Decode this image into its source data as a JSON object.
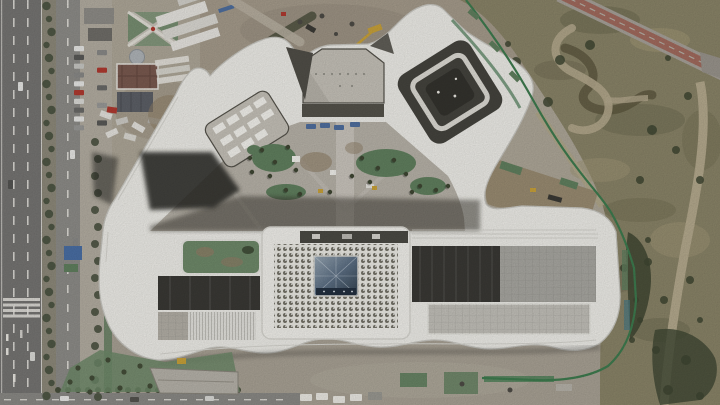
{
  "meta": {
    "type": "aerial-photograph",
    "subject": "top-down drone view of a serpentine white office campus under construction",
    "width": 720,
    "height": 405,
    "visible_text": []
  },
  "palette": {
    "ground": "#afa899",
    "ground_north": "#a69c8c",
    "ground_south": "#a9a295",
    "road": "#767573",
    "road_line": "#eceae4",
    "service_road": "#8e8d89",
    "sidewalk": "#b4aea2",
    "median": "#8e8a7b",
    "tree": "#4a5240",
    "shrub": "#3f4733",
    "tarp_green": "#61805f",
    "fence_green": "#3e7c4f",
    "garden_green": "#6f8a6a",
    "parkland": "#8a8468",
    "parkland_dark": "#6e6b51",
    "parkland_light": "#a29877",
    "scrub_dark": "#5d573f",
    "dirt_path": "#b5aa8e",
    "red_path": "#a26b5e",
    "band_white": "#efeee9",
    "band_edge": "#c9c8c2",
    "band_rib": "#dddcd6",
    "courtyard": "#b8b3a9",
    "courtyard_light": "#c6c2b9",
    "paving_light": "#ccc8c0",
    "glass_dark": "#403f39",
    "seam_dark": "#55534b",
    "roof_gray": "#a9a8a2",
    "roof_terrace": "#c3c1ba",
    "louver_white": "#e4e3de",
    "scaffold": "#b4b0a7",
    "dirt_pocket": "#9a8c72",
    "dirt_brown": "#8f7f68",
    "skylight_hi": "#9aa9b6",
    "skylight_mid": "#5d7085",
    "skylight_lo": "#33424f",
    "skylight_base": "#233040",
    "shadow": "#2b2a25",
    "crane_yellow": "#c9a23a",
    "truck_blue": "#4f6f9f",
    "equip_red": "#b03a30",
    "roof_brown": "#7a5a50",
    "roof_slate": "#5d6067",
    "dome_gray": "#b0b5b9",
    "white": "#f2f1ec"
  },
  "scene": {
    "elements": [
      "serpentine-white-building",
      "central-hall-perforated-roof",
      "glass-pyramid-skylight",
      "pentagon-courtyard",
      "spiral-wing",
      "central-landscaped-courtyard",
      "west-avenue-with-median-trees",
      "parked-car-column",
      "northwest-plaza-and-brown-roof-pavilion",
      "north-construction-yard-with-crane",
      "red-cycle-path",
      "east-parkland-with-walking-path",
      "green-construction-fence",
      "south-construction-strip"
    ]
  },
  "procedural": {
    "lane_dashes": [
      {
        "x": 13,
        "y0": 0,
        "y1": 405,
        "len": 9,
        "gap": 9
      },
      {
        "x": 27,
        "y0": 0,
        "y1": 405,
        "len": 9,
        "gap": 9
      },
      {
        "x": 67,
        "y0": 0,
        "y1": 405,
        "len": 8,
        "gap": 11
      }
    ],
    "median_trees": {
      "x": 49,
      "y0": 6,
      "y1": 400,
      "step": 13,
      "r": 4.2
    },
    "street_trees": {
      "x": 95,
      "y0": 142,
      "y1": 402,
      "step": 17,
      "r": 4
    },
    "bottom_shrubs": {
      "y": 390,
      "x0": 58,
      "x1": 240,
      "step": 10,
      "r": 3
    },
    "parked_cars": {
      "x": 74,
      "x2": 97,
      "y0": 46,
      "step": 8.8,
      "count": 10,
      "w": 10,
      "h": 5.2,
      "colors": [
        "#e8e8e6",
        "#5a5a58",
        "#c9c9c5",
        "#8a8a88",
        "#e8e8e6",
        "#b03a30",
        "#dcdcd8",
        "#6a6a68",
        "#e8e8e6",
        "#9a9a98"
      ]
    },
    "crosswalk": {
      "x": 3,
      "w": 37,
      "y0": 298,
      "step": 5.5,
      "count": 4,
      "h": 3
    },
    "road_cars": [
      {
        "x": 18,
        "y": 82,
        "c": "#e8e8e6"
      },
      {
        "x": 8,
        "y": 180,
        "c": "#555553"
      },
      {
        "x": 30,
        "y": 352,
        "c": "#dcdcd8"
      },
      {
        "x": 70,
        "y": 150,
        "c": "#e8e8e6"
      },
      {
        "x": 73,
        "y": 238,
        "c": "#8a8a88"
      },
      {
        "x": 60,
        "y": 396,
        "c": "#e8e8e6",
        "horiz": true
      },
      {
        "x": 130,
        "y": 397,
        "c": "#55544f",
        "horiz": true
      },
      {
        "x": 205,
        "y": 396,
        "c": "#dcdcd8",
        "horiz": true
      }
    ],
    "bottom_dashes": {
      "y": 399,
      "x0": 4,
      "x1": 290,
      "len": 7,
      "gap": 9
    },
    "courtyard_trees": [
      [
        262,
        150
      ],
      [
        275,
        162
      ],
      [
        288,
        147
      ],
      [
        270,
        176
      ],
      [
        296,
        170
      ],
      [
        362,
        158
      ],
      [
        378,
        168
      ],
      [
        394,
        160
      ],
      [
        406,
        174
      ],
      [
        420,
        186
      ],
      [
        436,
        190
      ],
      [
        286,
        190
      ],
      [
        300,
        194
      ],
      [
        250,
        158
      ],
      [
        352,
        176
      ],
      [
        370,
        182
      ],
      [
        448,
        186
      ],
      [
        252,
        172
      ],
      [
        330,
        192
      ],
      [
        412,
        192
      ]
    ],
    "parkland_trees": [
      [
        508,
        44
      ],
      [
        516,
        62
      ],
      [
        528,
        84
      ],
      [
        548,
        102
      ],
      [
        560,
        60
      ],
      [
        590,
        45
      ],
      [
        640,
        30
      ],
      [
        668,
        58
      ],
      [
        688,
        96
      ],
      [
        700,
        64
      ],
      [
        652,
        130
      ],
      [
        676,
        150
      ],
      [
        640,
        180
      ],
      [
        610,
        240
      ],
      [
        624,
        268
      ],
      [
        648,
        240
      ],
      [
        636,
        300
      ],
      [
        700,
        180
      ],
      [
        690,
        280
      ],
      [
        664,
        300
      ],
      [
        700,
        320
      ],
      [
        656,
        350
      ],
      [
        686,
        360
      ],
      [
        700,
        396
      ],
      [
        668,
        390
      ],
      [
        640,
        320
      ],
      [
        632,
        340
      ],
      [
        648,
        262
      ]
    ],
    "sw_green_trees": [
      [
        78,
        368
      ],
      [
        92,
        378
      ],
      [
        108,
        360
      ],
      [
        124,
        372
      ],
      [
        140,
        366
      ],
      [
        156,
        374
      ],
      [
        90,
        392
      ],
      [
        120,
        388
      ],
      [
        150,
        386
      ],
      [
        170,
        380
      ],
      [
        70,
        382
      ]
    ],
    "blue_trucks": [
      [
        306,
        124
      ],
      [
        320,
        123
      ],
      [
        334,
        125
      ],
      [
        350,
        122
      ]
    ],
    "bottom_trucks": [
      [
        300,
        394
      ],
      [
        316,
        393
      ],
      [
        333,
        396
      ],
      [
        350,
        394
      ]
    ]
  }
}
